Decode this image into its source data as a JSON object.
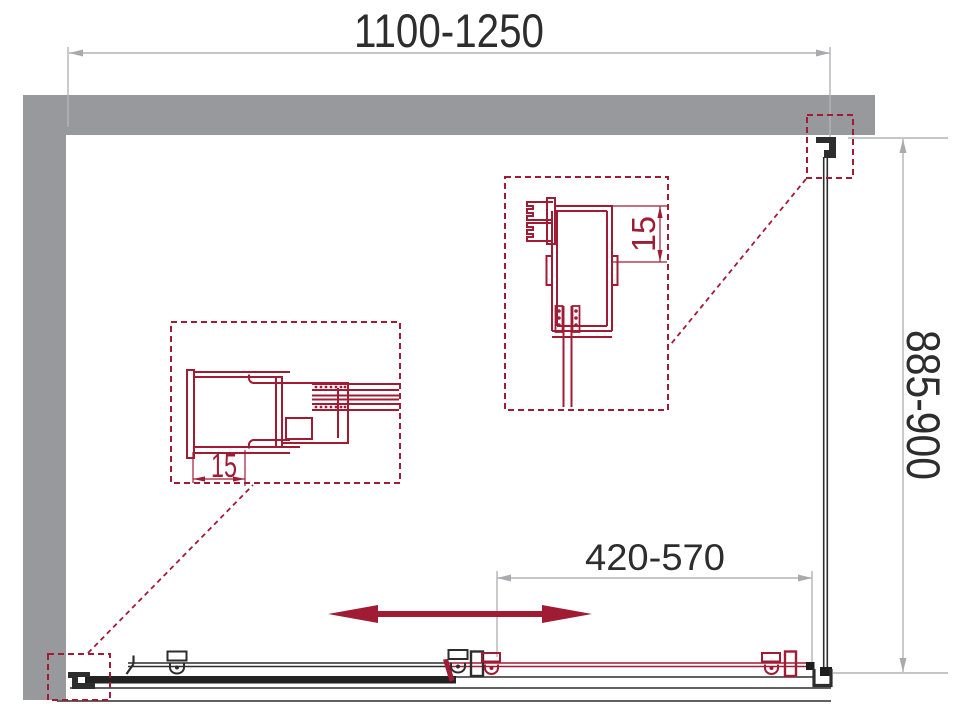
{
  "drawing": {
    "dimensions": {
      "overall_width": "1100-1250",
      "side_depth": "885-900",
      "door_opening": "420-570",
      "left_profile_adjust": "15",
      "right_profile_adjust": "15"
    },
    "colors": {
      "accent_red": "#A01C34",
      "wall_gray": "#98999C",
      "dimension_gray": "#ABABAD",
      "line_black": "#2D2D2D"
    }
  }
}
